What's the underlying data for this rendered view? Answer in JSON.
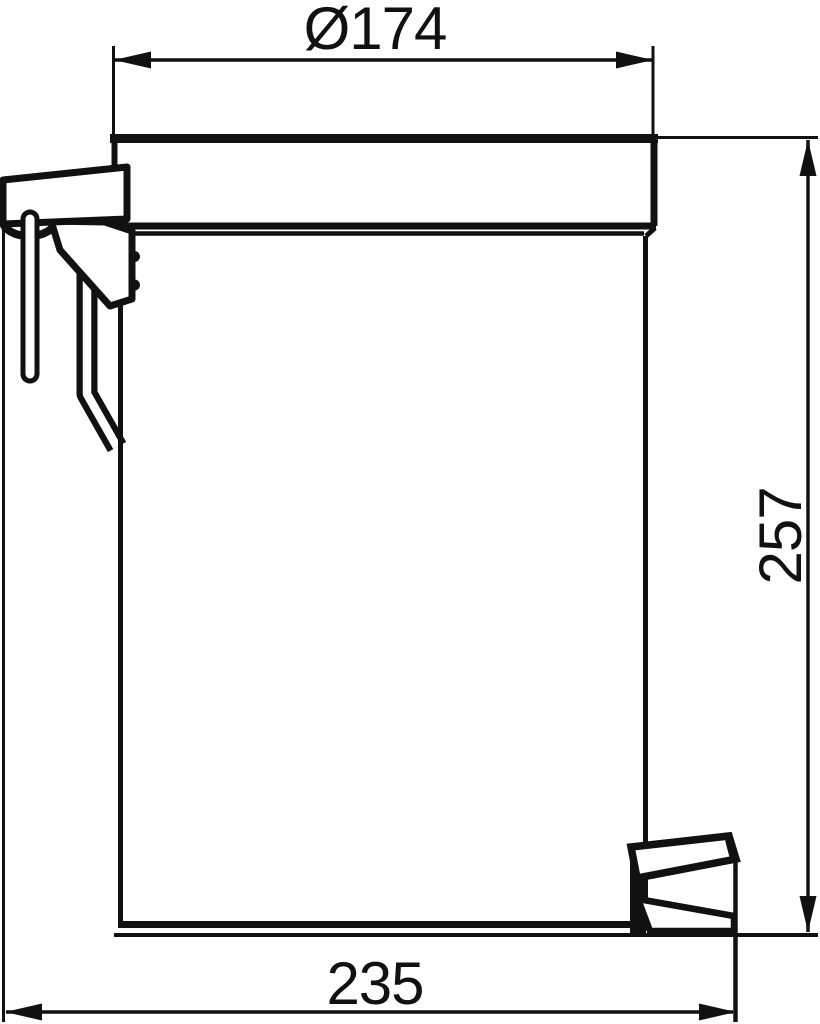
{
  "drawing": {
    "kind": "technical-dimension-drawing",
    "subject": "wall-mounted pedal waste bin, side elevation",
    "background_color": "#ffffff",
    "line_color": "#111111",
    "dimensions": {
      "diameter": {
        "label": "Ø174",
        "value": 174
      },
      "height": {
        "label": "257",
        "value": 257
      },
      "depth": {
        "label": "235",
        "value": 235
      }
    }
  }
}
